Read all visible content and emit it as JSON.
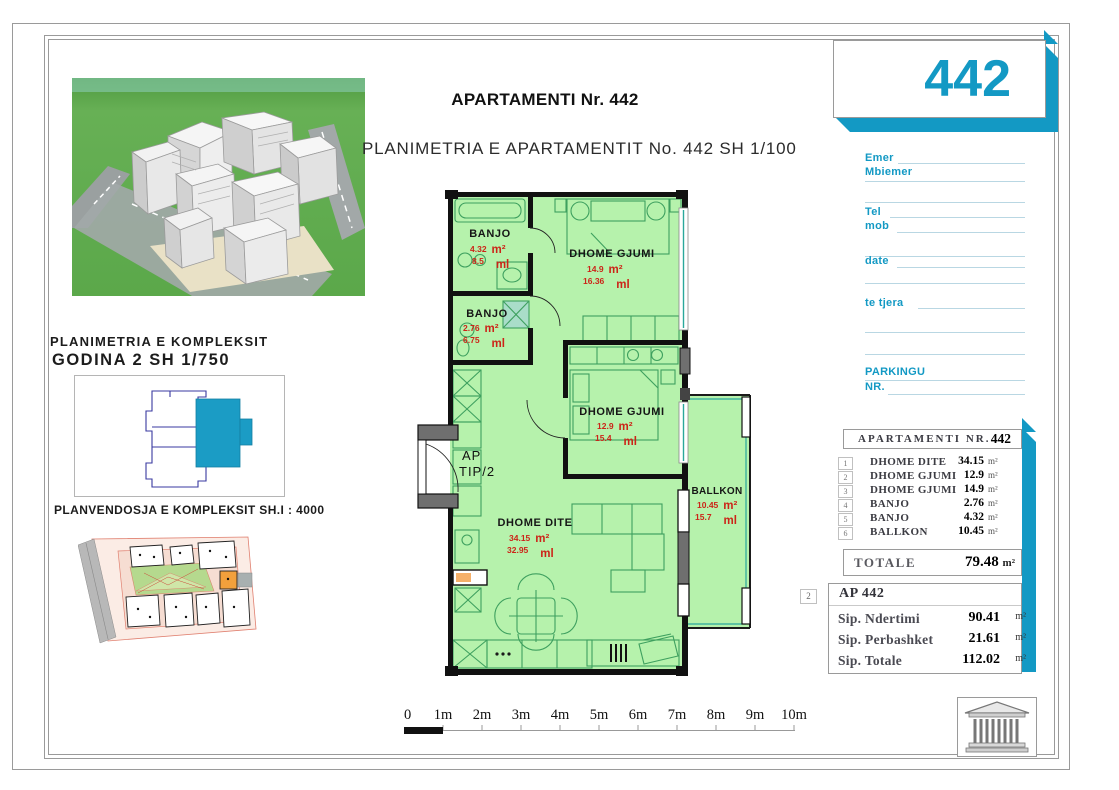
{
  "header": {
    "title": "APARTAMENTI Nr. 442",
    "subtitle": "PLANIMETRIA E APARTAMENTIT No. 442 SH 1/100"
  },
  "left_panel": {
    "complex_title_line1": "PLANIMETRIA E KOMPLEKSIT",
    "complex_title_line2": "GODINA 2  SH 1/750",
    "site_caption": "PLANVENDOSJA E KOMPLEKSIT SH.I : 4000"
  },
  "floor_plan": {
    "unit_label_line1": "AP",
    "unit_label_line2": "TIP/2",
    "units": {
      "area": "m²",
      "perimeter": "ml"
    },
    "rooms": [
      {
        "name": "BANJO",
        "area": "4.32",
        "perimeter": "8.5"
      },
      {
        "name": "DHOME GJUMI",
        "area": "14.9",
        "perimeter": "16.36"
      },
      {
        "name": "BANJO",
        "area": "2.76",
        "perimeter": "6.75"
      },
      {
        "name": "DHOME GJUMI",
        "area": "12.9",
        "perimeter": "15.4"
      },
      {
        "name": "DHOME DITE",
        "area": "34.15",
        "perimeter": "32.95"
      },
      {
        "name": "BALLKON",
        "area": "10.45",
        "perimeter": "15.7"
      }
    ]
  },
  "sidebar": {
    "unit_number": "442",
    "fields": {
      "name": "Emer",
      "surname": "Mbiemer",
      "tel": "Tel",
      "mob": "mob",
      "date": "date",
      "other": "te tjera",
      "parking": "PARKINGU",
      "nr": "NR."
    },
    "table": {
      "header_label": "APARTAMENTI  NR.",
      "header_value": "442",
      "area_unit": "m²",
      "rows": [
        {
          "no": "1",
          "name": "DHOME DITE",
          "value": "34.15"
        },
        {
          "no": "2",
          "name": "DHOME GJUMI",
          "value": "12.9"
        },
        {
          "no": "3",
          "name": "DHOME GJUMI",
          "value": "14.9"
        },
        {
          "no": "4",
          "name": "BANJO",
          "value": "2.76"
        },
        {
          "no": "5",
          "name": "BANJO",
          "value": "4.32"
        },
        {
          "no": "6",
          "name": "BALLKON",
          "value": "10.45"
        }
      ],
      "total_label": "TOTALE",
      "total_value": "79.48"
    },
    "summary": {
      "badge": "2",
      "title": "AP 442",
      "rows": [
        {
          "label": "Sip. Ndertimi",
          "value": "90.41"
        },
        {
          "label": "Sip. Perbashket",
          "value": "21.61"
        },
        {
          "label": "Sip. Totale",
          "value": "112.02"
        }
      ]
    }
  },
  "scale_bar": {
    "labels": [
      "0",
      "1m",
      "2m",
      "3m",
      "4m",
      "5m",
      "6m",
      "7m",
      "8m",
      "9m",
      "10m"
    ]
  },
  "colors": {
    "accent": "#1399c4",
    "plan_green": "#b6f2ac",
    "dim_red": "#cc2418"
  }
}
